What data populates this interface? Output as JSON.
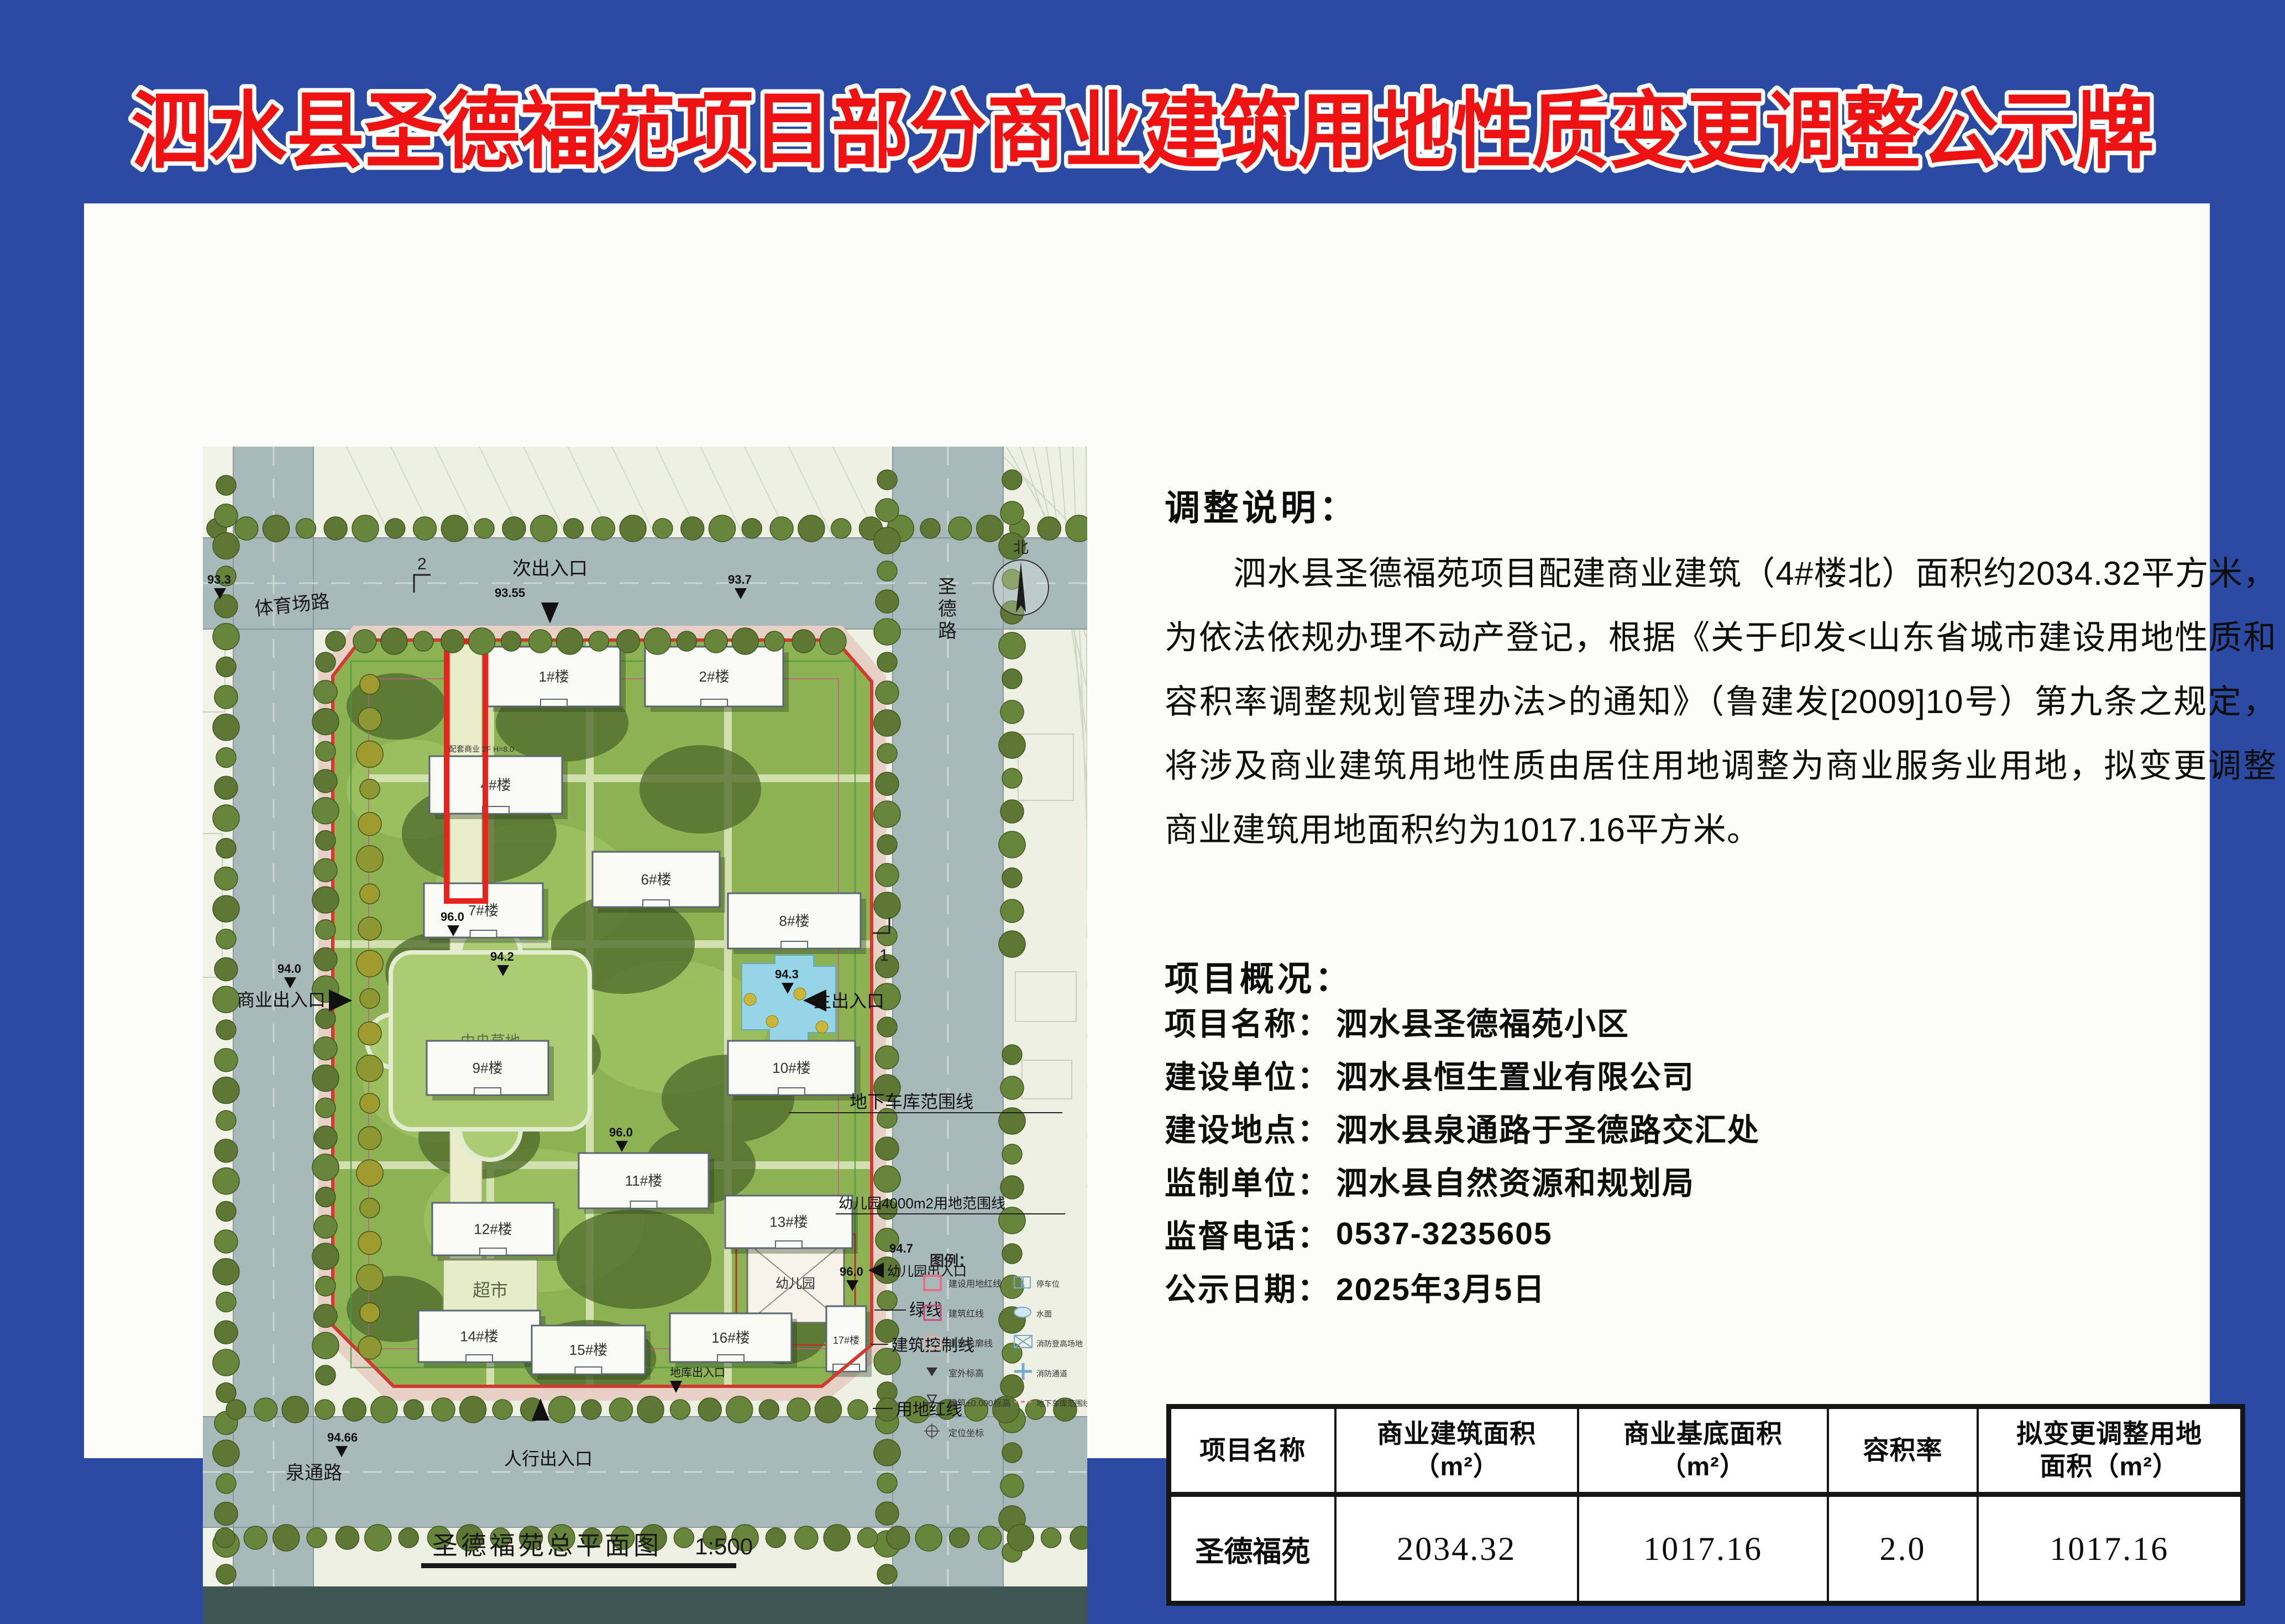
{
  "page": {
    "title": "泗水县圣德福苑项目部分商业建筑用地性质变更调整公示牌",
    "colors": {
      "background_blue": "#2b4aa4",
      "title_red": "#ee1212",
      "title_outline": "#ffffff",
      "boundary_red": "#d4392f",
      "highlight_red": "#e8231d"
    }
  },
  "adjustment": {
    "heading": "调整说明：",
    "body": "泗水县圣德福苑项目配建商业建筑（4#楼北）面积约2034.32平方米，为依法依规办理不动产登记，根据《关于印发<山东省城市建设用地性质和容积率调整规划管理办法>的通知》（鲁建发[2009]10号）第九条之规定，将涉及商业建筑用地性质由居住用地调整为商业服务业用地，拟变更调整商业建筑用地面积约为1017.16平方米。"
  },
  "overview": {
    "heading": "项目概况：",
    "items": [
      {
        "label": "项目名称：",
        "value": "泗水县圣德福苑小区"
      },
      {
        "label": "建设单位：",
        "value": "泗水县恒生置业有限公司"
      },
      {
        "label": "建设地点：",
        "value": "泗水县泉通路于圣德路交汇处"
      },
      {
        "label": "监制单位：",
        "value": "泗水县自然资源和规划局"
      },
      {
        "label": "监督电话：",
        "value": "0537-3235605"
      },
      {
        "label": "公示日期：",
        "value": "2025年3月5日"
      }
    ]
  },
  "table": {
    "headers": [
      "项目名称",
      "商业建筑面积\n（m²）",
      "商业基底面积\n（m²）",
      "容积率",
      "拟变更调整用地\n面积（m²）"
    ],
    "rows": [
      [
        "圣德福苑",
        "2034.32",
        "1017.16",
        "2.0",
        "1017.16"
      ]
    ]
  },
  "map": {
    "caption": "圣德福苑总平面图",
    "caption_scale": "1:500",
    "labels": {
      "road_top": "体育场路",
      "road_right": "圣德路",
      "road_bottom": "泉通路",
      "entry_secondary": "次出入口",
      "entry_main": "主出入口",
      "entry_commercial": "商业出入口",
      "entry_pedestrian": "人行出入口",
      "entry_kindergarten": "幼儿园出入口",
      "entry_garage": "地库出入口",
      "garage_line": "地下车库范围线",
      "kg_line": "幼儿园4000m2用地范围线",
      "green_line": "绿线",
      "building_control_line": "建筑控制线",
      "red_line": "用地红线",
      "central_lawn": "中央草地",
      "supermarket": "超市",
      "kindergarten": "幼儿园",
      "commercial_note": "配套商业 2F H=8.0",
      "compass_north": "北",
      "section_1": "1",
      "section_2": "2"
    },
    "elevations": {
      "e933": "93.3",
      "e937": "93.7",
      "e9355": "93.55",
      "e940": "94.0",
      "e942": "94.2",
      "e943": "94.3",
      "e9466": "94.66",
      "e947": "94.7",
      "e960": "96.0"
    },
    "buildings": [
      "1#楼",
      "2#楼",
      "4#楼",
      "6#楼",
      "7#楼",
      "8#楼",
      "9#楼",
      "10#楼",
      "11#楼",
      "12#楼",
      "13#楼",
      "14#楼",
      "15#楼",
      "16#楼",
      "17#楼"
    ],
    "legend": {
      "title": "图例：",
      "items": [
        "建设用地红线",
        "建筑红线",
        "建筑轮廓线",
        "室外标高",
        "建筑±0.000标高",
        "定位坐标",
        "停车位",
        "水面",
        "消防登高场地",
        "消防通道",
        "地下车库范围线"
      ]
    }
  }
}
